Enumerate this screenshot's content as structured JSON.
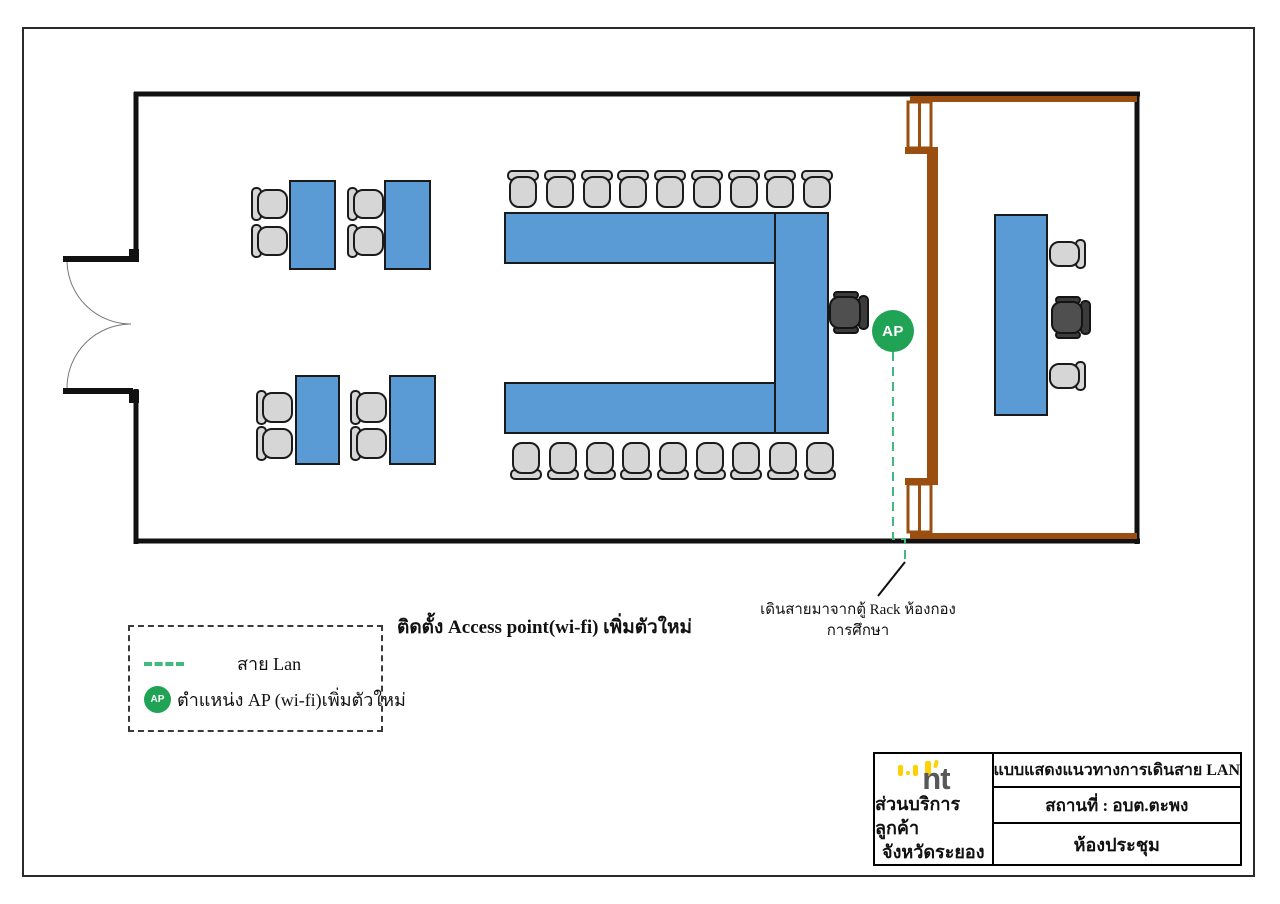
{
  "ap": {
    "label": "AP"
  },
  "notes": {
    "install": "ติดตั้ง Access point(wi-fi) เพิ่มตัวใหม่",
    "cable_line1": "เดินสายมาจากตู้ Rack ห้องกอง",
    "cable_line2": "การศึกษา"
  },
  "legend": {
    "lan_label": "สาย Lan",
    "ap_label": "ตำแหน่ง AP (wi-fi)เพิ่มตัวใหม่"
  },
  "title_block": {
    "logo_text": "nt",
    "org_line1": "ส่วนบริการลูกค้า",
    "org_line2": "จังหวัดระยอง",
    "drawing_title": "แบบแสดงแนวทางการเดินสาย LAN",
    "location": "สถานที่ :  อบต.ตะพง",
    "room": "ห้องประชุม"
  },
  "floorplan": {
    "colors": {
      "wall": "#111111",
      "table": "#5b9bd5",
      "table_stroke": "#1a1a1a",
      "chair": "#d6d6d6",
      "chair_stroke": "#1b1b1b",
      "exec": "#4f4f4f",
      "exec_dark": "#3b3b3b",
      "exec_stroke": "#141414",
      "partition": "#9a4f10",
      "cable": "#44b97d",
      "ap_green": "#21a355",
      "arc": "#777777",
      "pointer": "#111111"
    },
    "walls": [
      [
        134,
        94,
        1140,
        94,
        5
      ],
      [
        134,
        541,
        1140,
        541,
        5
      ],
      [
        1137,
        92,
        1137,
        544,
        5
      ],
      [
        136,
        92,
        136,
        259,
        5
      ],
      [
        136,
        389,
        136,
        544,
        5
      ]
    ],
    "door": {
      "leaves": [
        [
          63,
          256,
          70,
          6
        ],
        [
          63,
          388,
          70,
          6
        ]
      ],
      "caps": [
        [
          129,
          249,
          10,
          13
        ],
        [
          129,
          390,
          10,
          13
        ]
      ],
      "arcs": [
        "M 67 262 A 64 64 0 0 0 131 324",
        "M 67 388 A 64 64 0 0 1 131 324"
      ]
    },
    "partition": {
      "bars": [
        [
          910,
          96,
          227,
          6
        ],
        [
          905,
          147,
          33,
          7
        ],
        [
          927,
          152,
          11,
          330
        ],
        [
          905,
          478,
          33,
          7
        ],
        [
          910,
          533,
          227,
          6
        ]
      ],
      "windows": [
        [
          908,
          102,
          23,
          46
        ],
        [
          908,
          484,
          23,
          48
        ]
      ]
    },
    "tables": [
      [
        290,
        181,
        45,
        88
      ],
      [
        385,
        181,
        45,
        88
      ],
      [
        296,
        376,
        43,
        88
      ],
      [
        390,
        376,
        45,
        88
      ],
      [
        505,
        213,
        270,
        50
      ],
      [
        775,
        213,
        53,
        220
      ],
      [
        505,
        383,
        270,
        50
      ],
      [
        995,
        215,
        52,
        200
      ]
    ],
    "chairs": [
      [
        252,
        188,
        35,
        32,
        "right"
      ],
      [
        252,
        225,
        35,
        32,
        "right"
      ],
      [
        348,
        188,
        35,
        32,
        "right"
      ],
      [
        348,
        225,
        35,
        32,
        "right"
      ],
      [
        257,
        391,
        35,
        33,
        "right"
      ],
      [
        257,
        427,
        35,
        33,
        "right"
      ],
      [
        351,
        391,
        35,
        33,
        "right"
      ],
      [
        351,
        427,
        35,
        33,
        "right"
      ],
      [
        508,
        171,
        30,
        36,
        "down"
      ],
      [
        545,
        171,
        30,
        36,
        "down"
      ],
      [
        582,
        171,
        30,
        36,
        "down"
      ],
      [
        618,
        171,
        30,
        36,
        "down"
      ],
      [
        655,
        171,
        30,
        36,
        "down"
      ],
      [
        692,
        171,
        30,
        36,
        "down"
      ],
      [
        729,
        171,
        30,
        36,
        "down"
      ],
      [
        765,
        171,
        30,
        36,
        "down"
      ],
      [
        802,
        171,
        30,
        36,
        "down"
      ],
      [
        511,
        443,
        30,
        36,
        "up"
      ],
      [
        548,
        443,
        30,
        36,
        "up"
      ],
      [
        585,
        443,
        30,
        36,
        "up"
      ],
      [
        621,
        443,
        30,
        36,
        "up"
      ],
      [
        658,
        443,
        30,
        36,
        "up"
      ],
      [
        695,
        443,
        30,
        36,
        "up"
      ],
      [
        731,
        443,
        30,
        36,
        "up"
      ],
      [
        768,
        443,
        30,
        36,
        "up"
      ],
      [
        805,
        443,
        30,
        36,
        "up"
      ],
      [
        1050,
        240,
        35,
        28,
        "left"
      ],
      [
        1050,
        362,
        35,
        28,
        "left"
      ]
    ],
    "exec_chairs": [
      [
        830,
        292,
        38,
        41
      ],
      [
        1052,
        297,
        38,
        41
      ]
    ],
    "cable_path": "M 893 352 V 539 H 905 V 561",
    "pointer_line": [
      905,
      562,
      878,
      596
    ]
  }
}
